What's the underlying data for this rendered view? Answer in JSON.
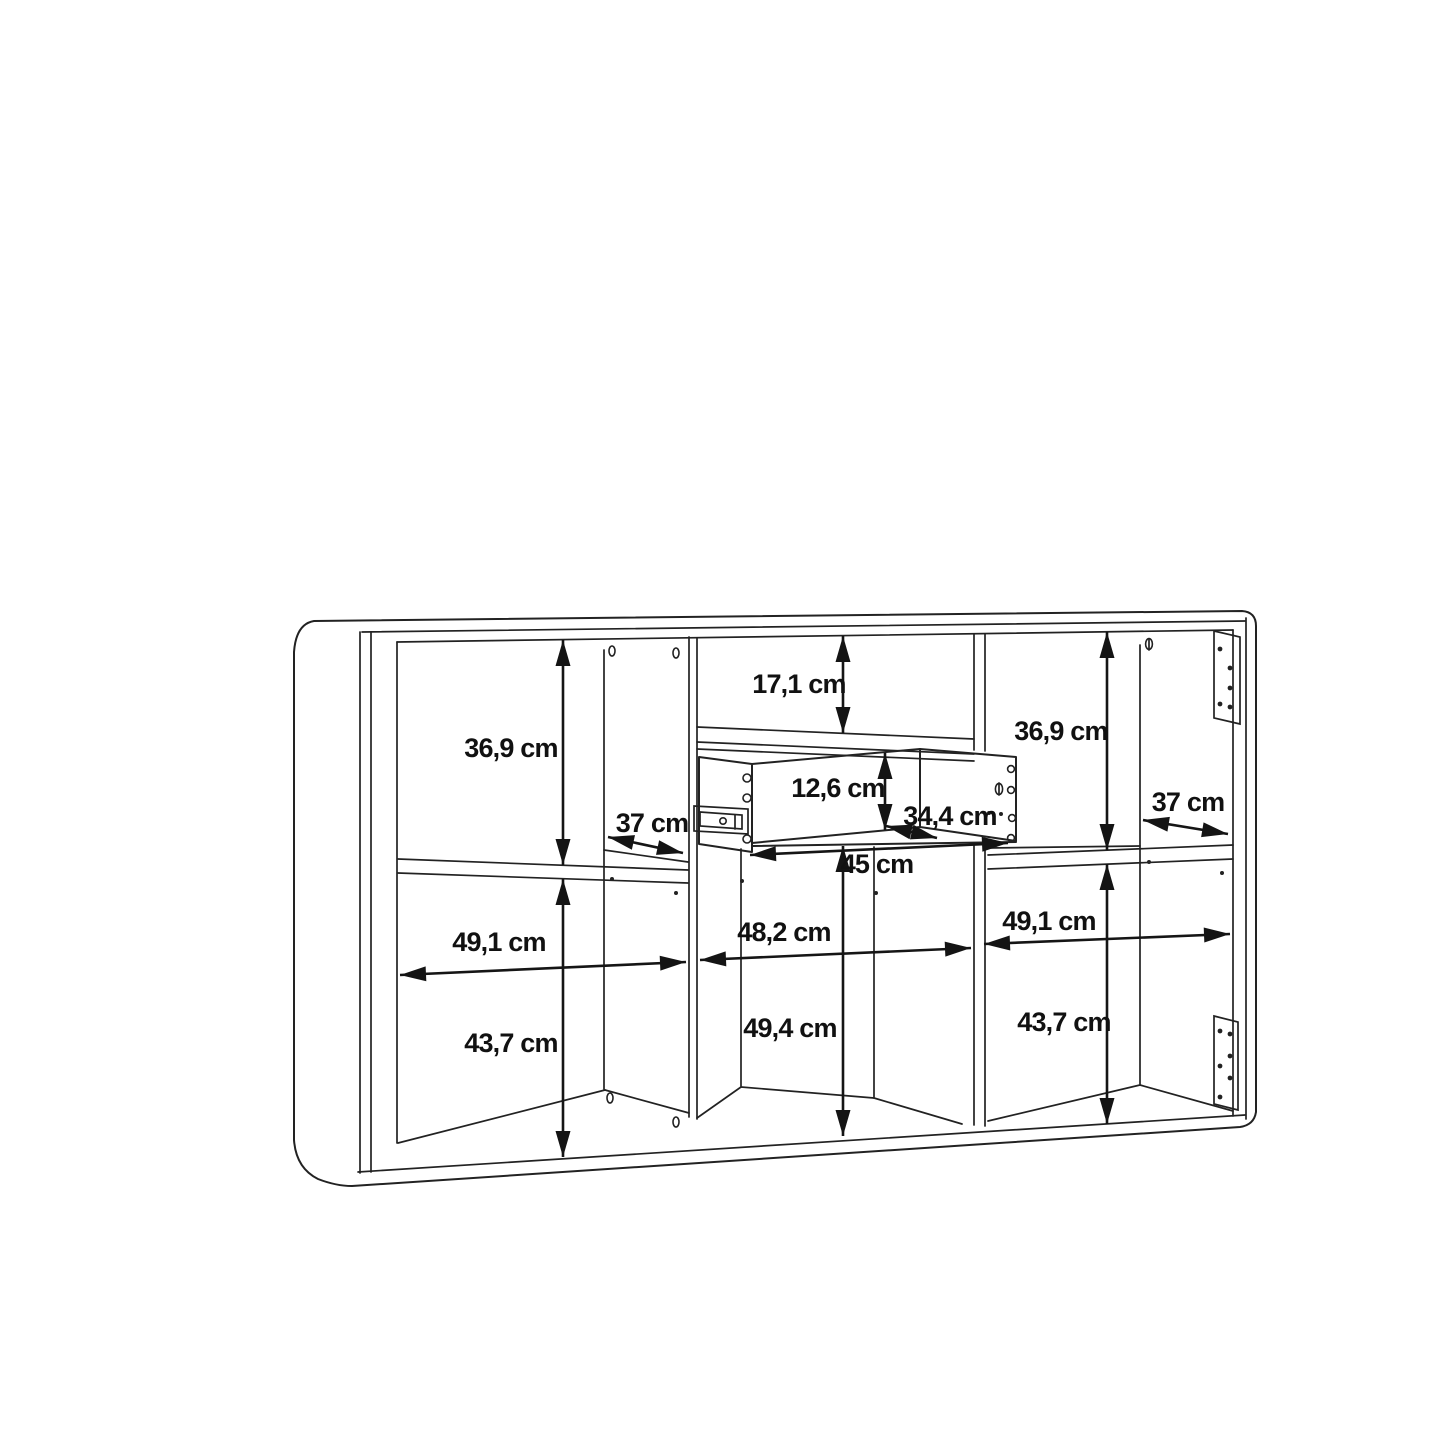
{
  "diagram": {
    "kind": "furniture-dimension-line-drawing",
    "unit": "cm",
    "colors": {
      "background": "#ffffff",
      "line": "#222222",
      "label": "#111111"
    },
    "labels": {
      "left_top_height": "36,9 cm",
      "middle_top_clearance": "17,1 cm",
      "right_top_height": "36,9 cm",
      "drawer_front_height": "12,6 cm",
      "left_shelf_depth": "37 cm",
      "drawer_inner_depth": "34,4 cm",
      "right_shelf_depth": "37 cm",
      "drawer_width": "45 cm",
      "left_compartment_width": "49,1 cm",
      "middle_compartment_width": "48,2 cm",
      "right_compartment_width": "49,1 cm",
      "left_bottom_height": "43,7 cm",
      "middle_bottom_height": "49,4 cm",
      "right_bottom_height": "43,7 cm"
    }
  }
}
